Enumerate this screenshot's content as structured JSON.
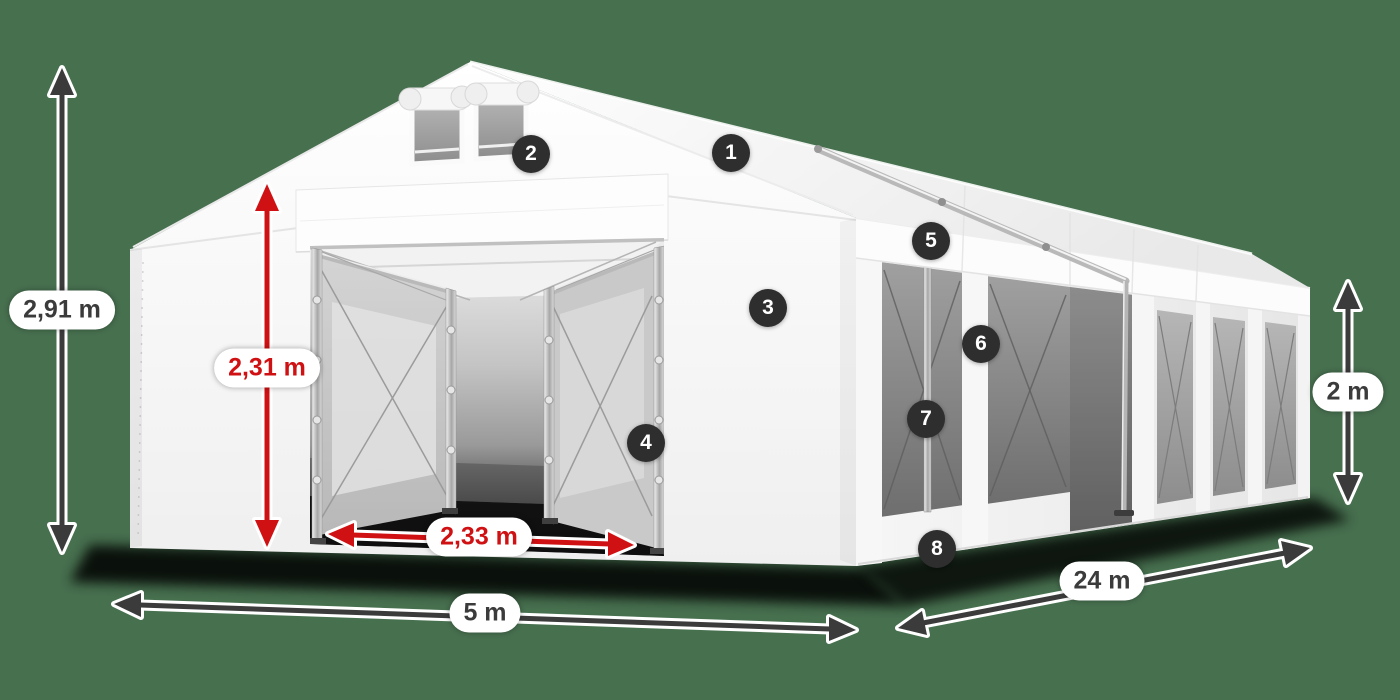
{
  "colors": {
    "background": "#47704f",
    "dimension_dark": "#3b3b3b",
    "dimension_red": "#cf1113",
    "badge_background": "#2e2e2e",
    "badge_text": "#ffffff",
    "label_background": "#ffffff"
  },
  "dimensions": {
    "total_height": {
      "label": "2,91 m",
      "accent": "dark"
    },
    "door_height": {
      "label": "2,31 m",
      "accent": "red"
    },
    "door_width": {
      "label": "2,33 m",
      "accent": "red"
    },
    "front_width": {
      "label": "5 m",
      "accent": "dark"
    },
    "side_length": {
      "label": "24 m",
      "accent": "dark"
    },
    "side_height": {
      "label": "2 m",
      "accent": "dark"
    }
  },
  "badges": [
    {
      "number": "1"
    },
    {
      "number": "2"
    },
    {
      "number": "3"
    },
    {
      "number": "4"
    },
    {
      "number": "5"
    },
    {
      "number": "6"
    },
    {
      "number": "7"
    },
    {
      "number": "8"
    }
  ]
}
